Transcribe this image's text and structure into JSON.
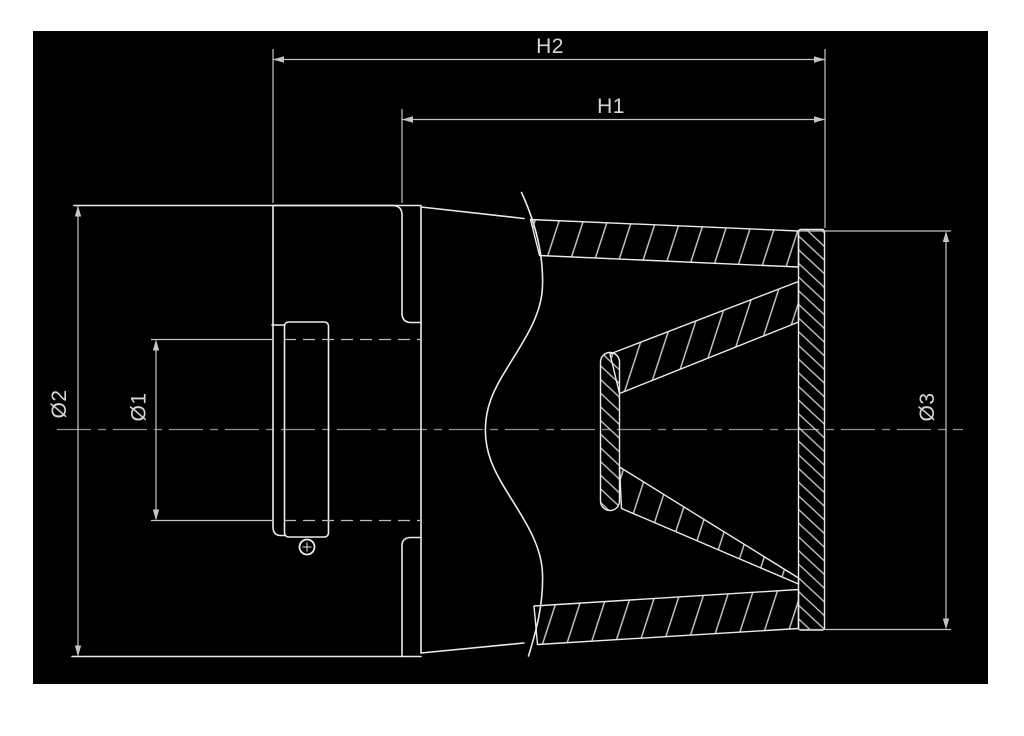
{
  "drawing": {
    "labels": {
      "h2": "H2",
      "h1": "H1",
      "dia1": "Ø1",
      "dia2": "Ø2",
      "dia3": "Ø3"
    },
    "colors": {
      "page": "#ffffff",
      "canvas": "#000000",
      "outline": "#ebebeb",
      "dim": "#c4c4c4",
      "hatch": "#d0d0d0",
      "hidden": "#bdbdbd",
      "centerline": "#8f8f8f",
      "label": "#d6d6d6"
    }
  }
}
